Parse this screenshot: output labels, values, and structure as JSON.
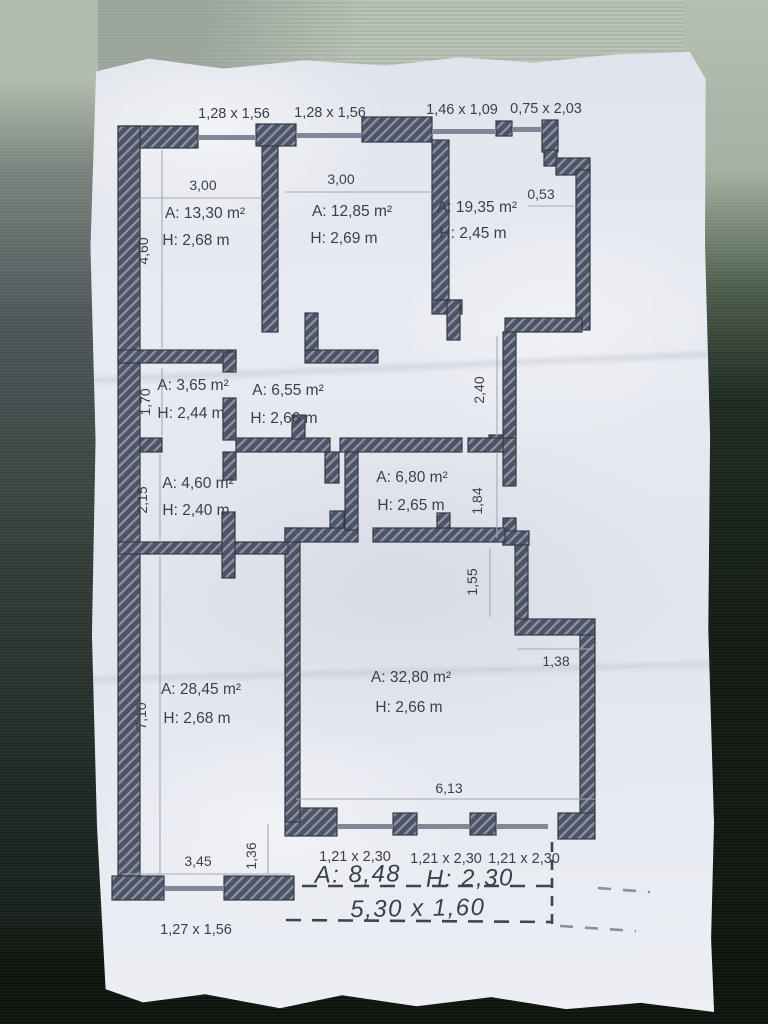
{
  "plan": {
    "title_note": "apartment floor plan",
    "colors": {
      "wall": "#4d5465",
      "wall_hatch": "#8d94a6",
      "paper": "#e9ebf2",
      "ink": "#3a3f4c",
      "hand_ink": "#2c313d"
    },
    "windows_top": [
      "1,28 x 1,56",
      "1,28 x 1,56",
      "1,46 x 1,09",
      "0,75 x 2,03"
    ],
    "windows_bottom": [
      "1,21 x 2,30",
      "1,21 x 2,30",
      "1,21 x 2,30"
    ],
    "window_bottom_left": "1,27 x 1,56",
    "rooms": [
      {
        "name": "room-13-30",
        "area": "A: 13,30 m²",
        "height": "H: 2,68 m"
      },
      {
        "name": "room-12-85",
        "area": "A: 12,85 m²",
        "height": "H: 2,69 m"
      },
      {
        "name": "room-19-35",
        "area": "A: 19,35 m²",
        "height": "H: 2,45 m"
      },
      {
        "name": "room-3-65",
        "area": "A: 3,65 m²",
        "height": "H: 2,44 m"
      },
      {
        "name": "room-6-55",
        "area": "A: 6,55 m²",
        "height": "H: 2,66 m"
      },
      {
        "name": "room-4-60",
        "area": "A: 4,60 m²",
        "height": "H: 2,40 m"
      },
      {
        "name": "room-6-80",
        "area": "A: 6,80 m²",
        "height": "H: 2,65 m"
      },
      {
        "name": "room-28-45",
        "area": "A: 28,45 m²",
        "height": "H: 2,68 m"
      },
      {
        "name": "room-32-80",
        "area": "A: 32,80 m²",
        "height": "H: 2,66 m"
      }
    ],
    "dims": {
      "w_room1330": "3,00",
      "w_room1285": "3,00",
      "offset_top_right": "0,53",
      "h_left_top": "4,60",
      "h_room365": "1,70",
      "h_room460": "2,15",
      "h_right_upper": "2,40",
      "h_right_mid": "1,84",
      "h_right_lower": "1,55",
      "w_step_right": "1,38",
      "h_left_bottom": "7,10",
      "w_room3280_bottom": "6,13",
      "h_step_bottom": "1,36",
      "w_room2845_bottom": "3,45"
    },
    "handwriting": {
      "area_part": "A: 8,48",
      "height_part": "H: 2,30",
      "size_line": "5,30 x 1,60"
    }
  }
}
